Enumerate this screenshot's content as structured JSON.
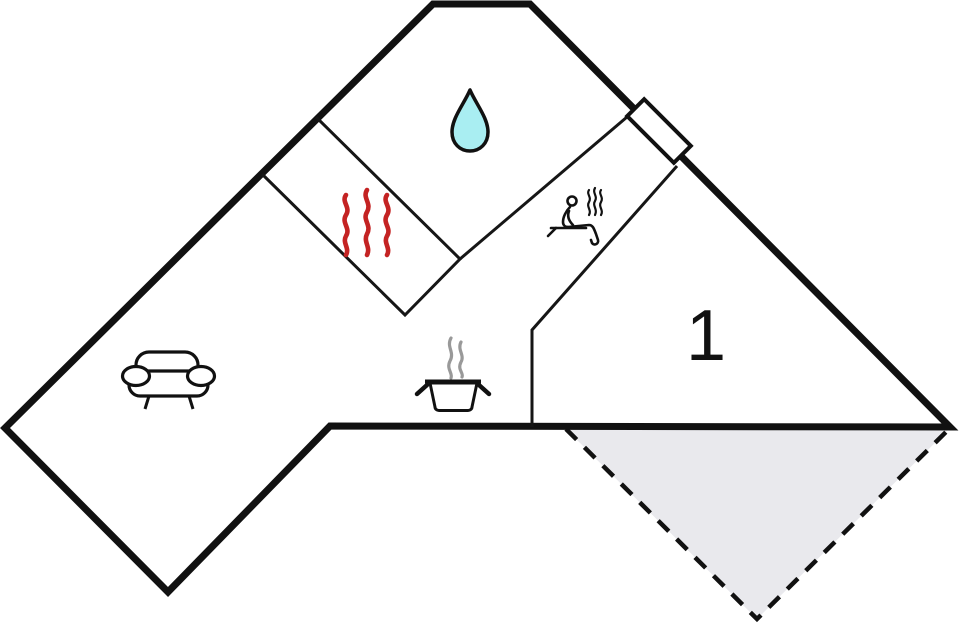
{
  "floorplan": {
    "room_label": "1",
    "colors": {
      "wall": "#111111",
      "interior_wall": "#161616",
      "water_drop": "#a9eef2",
      "heat_waves": "#c42323",
      "steam": "#999999",
      "figure_ink": "#111111",
      "terrace_fill": "#e9e9ed",
      "door_fill": "#ffffff",
      "background": "#ffffff"
    },
    "icons": [
      "water-drop-icon",
      "heat-waves-icon",
      "sauna-person-icon",
      "cooking-pot-icon",
      "sofa-icon",
      "door-icon",
      "terrace-dashed-area"
    ]
  }
}
